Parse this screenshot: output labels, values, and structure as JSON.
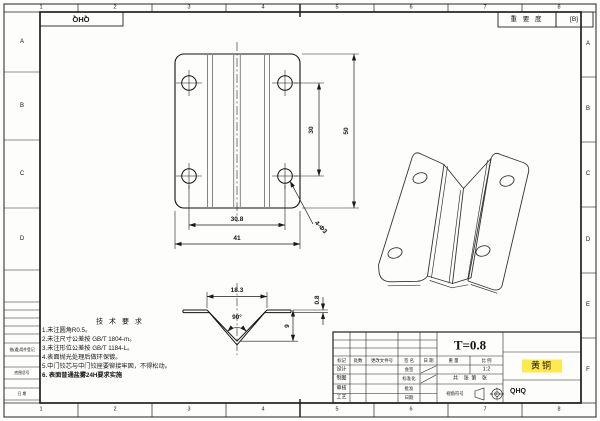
{
  "frame": {
    "cols": [
      "1",
      "2",
      "3",
      "4",
      "5",
      "6",
      "7",
      "8"
    ],
    "left_rows": [
      "A",
      "B",
      "C",
      "D"
    ],
    "right_rows": [
      "A",
      "B",
      "C",
      "D",
      "E",
      "F"
    ],
    "corner_code": "QHQ",
    "importance_label": "重 要 度",
    "importance_value": "[B]",
    "left_boxes": [
      "借(通)用件登记",
      "底图总号",
      "日  期"
    ]
  },
  "views": {
    "flat": {
      "hole_pitch_y": "30",
      "height": "50",
      "hole_pitch_x": "30.8",
      "width": "41",
      "holes_note": "4-Φ3"
    },
    "profile": {
      "top_width": "18.3",
      "angle": "90°",
      "depth": "9",
      "thickness": "0.8"
    }
  },
  "tech": {
    "title": "技 术 要 求",
    "items": [
      "1.未注圆角R0.5。",
      "2.未注尺寸公差按 GB/T 1804-m。",
      "3.未注形位公差按 GB/T 1184-L。",
      "4.表面抛光处理后做环保镀。",
      "5.中门铰芯与中门铰座要铆接牢固，不得松动。",
      "6. 表面普通盐雾24H要求实施"
    ]
  },
  "title_block": {
    "thickness": "T=0.8",
    "material": "黄铜",
    "code": "QHQ",
    "col_headers": {
      "mark": "标记",
      "count": "处数",
      "change_doc": "更改文件号",
      "signature": "签 名",
      "date": "日 期"
    },
    "left_labels": [
      "设计",
      "制图",
      "审核",
      "工艺"
    ],
    "mid_labels": [
      "会签",
      "标准化",
      "批准",
      "日期"
    ],
    "weight_label": "重 量",
    "scale_label": "比 例",
    "scale_value": "1:2",
    "sheets_label": "共    张  第    张",
    "view_symbol_label": "视角符号"
  }
}
